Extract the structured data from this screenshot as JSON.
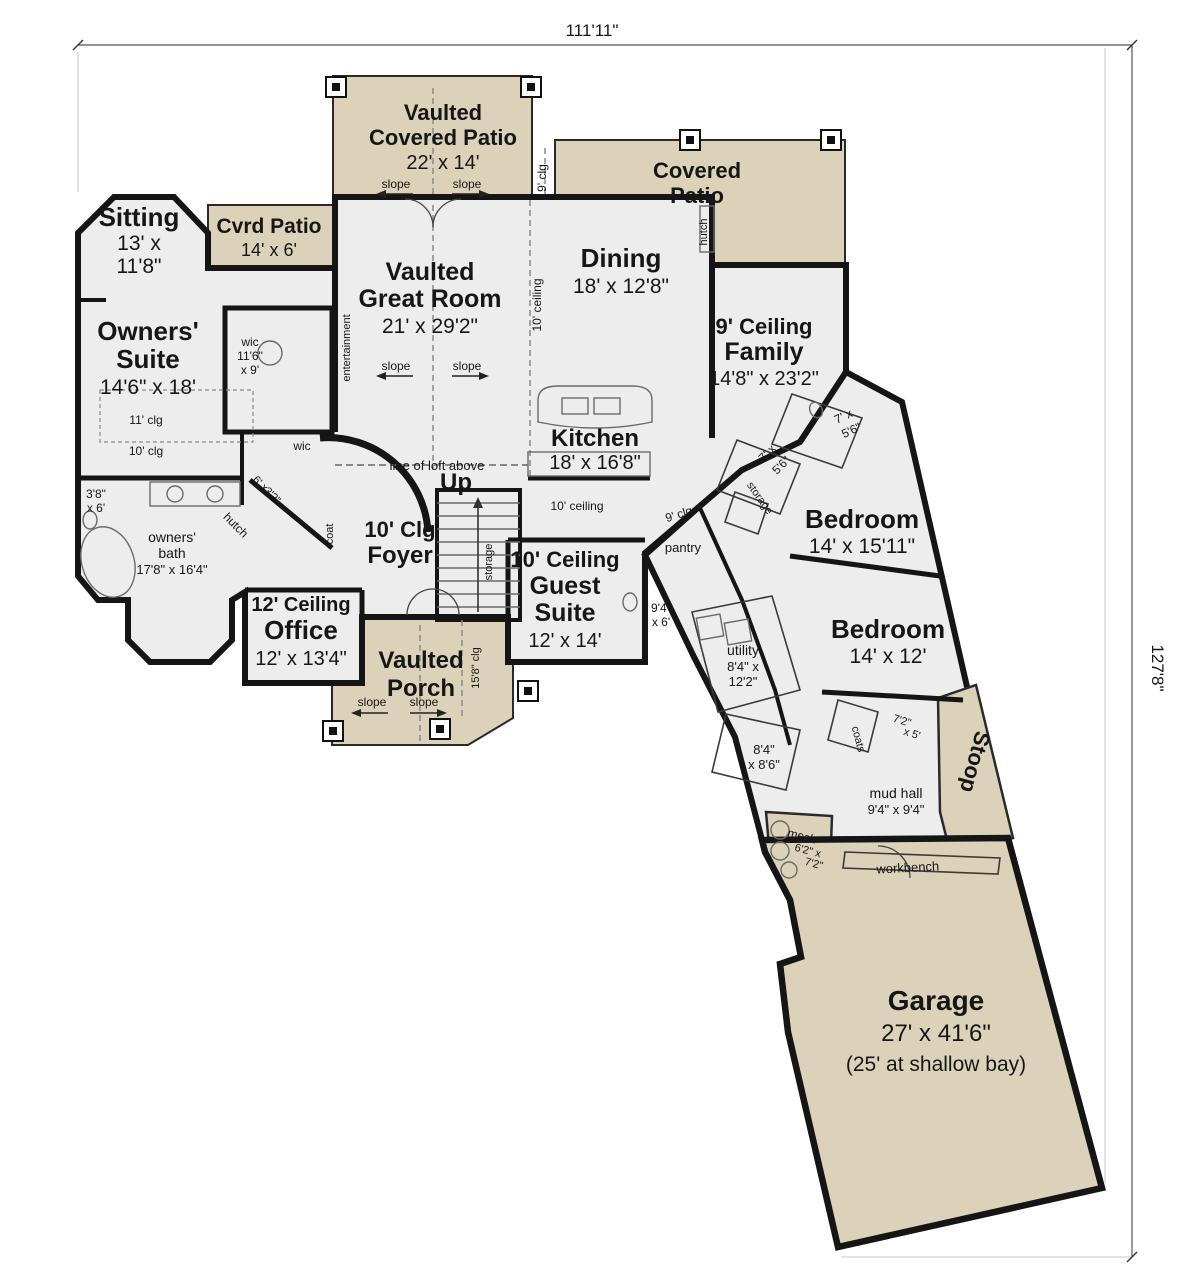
{
  "dims": {
    "width": "111'11\"",
    "height": "127'8\""
  },
  "rooms": {
    "vaulted_covered_patio": {
      "name1": "Vaulted",
      "name2": "Covered Patio",
      "dims": "22' x 14'"
    },
    "covered_patio": {
      "name1": "Covered",
      "name2": "Patio"
    },
    "cvrd_patio": {
      "name": "Cvrd Patio",
      "dims": "14' x 6'"
    },
    "sitting": {
      "name": "Sitting",
      "dims1": "13' x",
      "dims2": "11'8\""
    },
    "owners_suite": {
      "name1": "Owners'",
      "name2": "Suite",
      "dims": "14'6\" x 18'",
      "clg_upper": "11' clg",
      "clg_lower": "10' clg"
    },
    "great_room": {
      "name1": "Vaulted",
      "name2": "Great Room",
      "dims": "21' x 29'2\""
    },
    "dining": {
      "name": "Dining",
      "dims": "18' x 12'8\""
    },
    "family": {
      "ceiling": "9' Ceiling",
      "name": "Family",
      "dims": "14'8\" x 23'2\""
    },
    "kitchen": {
      "name": "Kitchen",
      "dims": "18' x 16'8\""
    },
    "foyer": {
      "ceiling": "10' Clg",
      "name": "Foyer"
    },
    "guest_suite": {
      "ceiling": "10' Ceiling",
      "name1": "Guest",
      "name2": "Suite",
      "dims": "12' x 14'"
    },
    "office": {
      "ceiling": "12' Ceiling",
      "name": "Office",
      "dims": "12' x 13'4\""
    },
    "vaulted_porch": {
      "name1": "Vaulted",
      "name2": "Porch"
    },
    "bedroom_1": {
      "name": "Bedroom",
      "dims": "14' x 15'11\""
    },
    "bedroom_2": {
      "name": "Bedroom",
      "dims": "14' x 12'"
    },
    "garage": {
      "name": "Garage",
      "dims": "27' x 41'6\"",
      "note": "(25' at shallow bay)"
    },
    "owners_bath": {
      "name1": "owners'",
      "name2": "bath",
      "dims": "17'8\" x 16'4\""
    },
    "utility": {
      "name": "utility",
      "dims1": "8'4\" x",
      "dims2": "12'2\""
    },
    "mud_hall": {
      "name": "mud hall",
      "dims": "9'4\" x 9'4\""
    },
    "mech": {
      "name": "mech",
      "dims1": "6'2\" x",
      "dims2": "7'2\""
    },
    "stoop": {
      "name": "Stoop"
    }
  },
  "labels": {
    "up": "Up",
    "slope": "slope",
    "loft": "line of loft above",
    "entertainment": "entertainment",
    "hutch": "hutch",
    "coat": "coat",
    "coats": "coats",
    "pantry": "pantry",
    "storage": "storage",
    "workbench": "workbench",
    "wic": "wic",
    "clg9": "9' clg",
    "ceiling10": "10' ceiling",
    "clg15_8": "15'8\" clg",
    "wic_dims1": "wic",
    "wic_dims2": "11'6\"",
    "wic_dims3": "x 9'",
    "bath_3_8_1": "3'8\"",
    "bath_3_8_2": "x 6'",
    "bath_7_1": "7' x",
    "bath_7_2": "5'6\"",
    "bath_9_4_1": "9'4\"",
    "bath_9_4_2": "x 6'",
    "bath_8_4_1": "8'4\"",
    "bath_8_4_2": "x 8'6\"",
    "closet_6_1": "6' x",
    "closet_6_2": "3'2\"",
    "closet_7_1": "7'2\"",
    "closet_7_2": "x 5'"
  },
  "colors": {
    "patio": "#dcd2ba",
    "floor": "#ededed",
    "wall": "#151515",
    "background": "#ffffff"
  }
}
